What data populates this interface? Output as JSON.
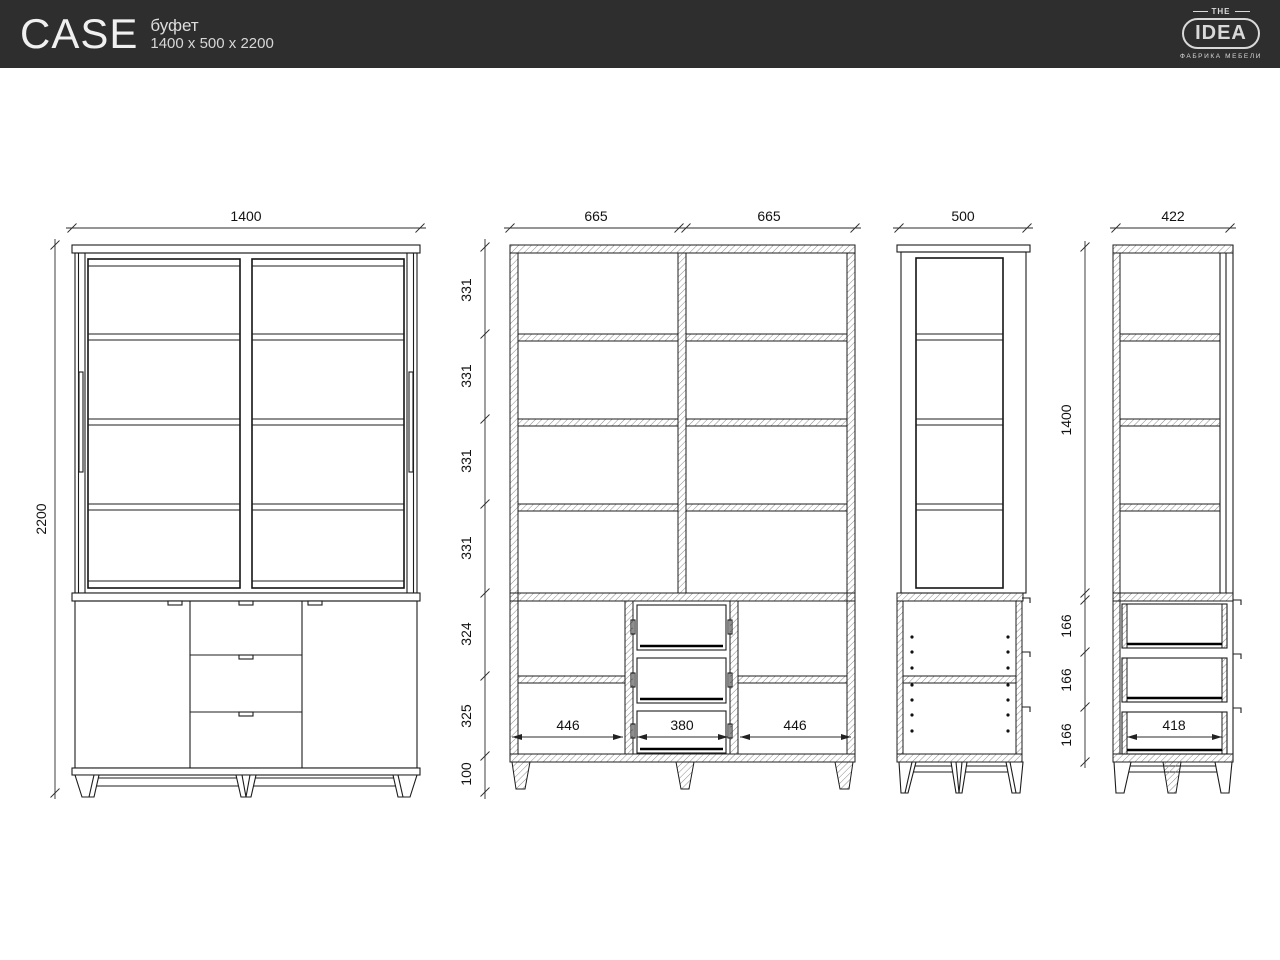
{
  "header": {
    "product_name": "CASE",
    "product_type": "буфет",
    "product_size": "1400 x 500 x 2200",
    "logo": {
      "the": "THE",
      "idea": "IDEA",
      "tagline": "ФАБРИКА МЕБЕЛИ"
    }
  },
  "colors": {
    "header_bg": "#2e2e2e",
    "header_text": "#ececec",
    "line": "#1c1c1c",
    "paper": "#ffffff"
  },
  "dims": {
    "front": {
      "width": "1400",
      "height": "2200"
    },
    "front_section": {
      "top_left": "665",
      "top_right": "665",
      "v1": "331",
      "v2": "331",
      "v3": "331",
      "v4": "331",
      "v5": "324",
      "v6": "325",
      "v7": "100",
      "inner_left": "446",
      "inner_center": "380",
      "inner_right": "446"
    },
    "side": {
      "width": "500"
    },
    "side_section": {
      "width": "422",
      "upper_height": "1400",
      "d1": "166",
      "d2": "166",
      "d3": "166",
      "inner": "418"
    }
  }
}
